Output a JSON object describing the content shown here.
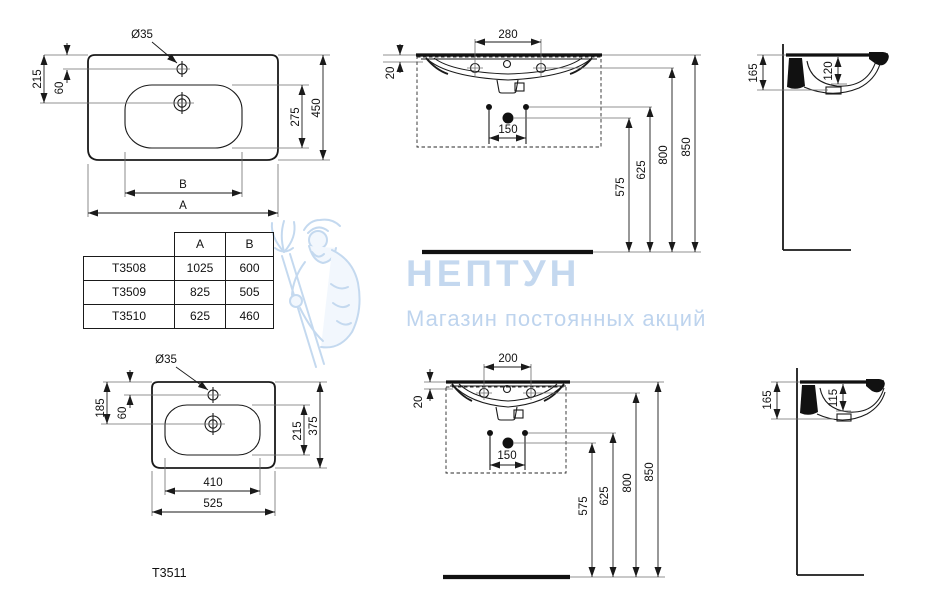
{
  "watermark": {
    "title": "НЕПТУН",
    "subtitle": "Магазин постоянных акций"
  },
  "caption": "T3511",
  "colors": {
    "line": "#1a1a1a",
    "extension_line": "#6e6e6e",
    "watermark_title": "#c4d8ef",
    "watermark_subtitle": "#bed4ee",
    "watermark_figure": "#b9d3ee"
  },
  "table": {
    "headers": [
      "",
      "A",
      "B"
    ],
    "rows": [
      [
        "T3508",
        "1025",
        "600"
      ],
      [
        "T3509",
        "825",
        "505"
      ],
      [
        "T3510",
        "625",
        "460"
      ]
    ]
  },
  "views": {
    "plan_large": {
      "dims": {
        "hole_dia": "Ø35",
        "top_to_drain": "215",
        "top_to_tap": "60",
        "basin_depth": "275",
        "overall_depth": "450",
        "basin_width": "B",
        "overall_width": "A"
      }
    },
    "front_large": {
      "dims": {
        "tap_spacing": "280",
        "rim_thickness": "20",
        "bolt_spacing": "150",
        "drain_height": "575",
        "bolt_height": "625",
        "tap_height": "800",
        "rim_height": "850"
      }
    },
    "side_large": {
      "dims": {
        "apron_height": "165",
        "bowl_depth": "120"
      }
    },
    "plan_small": {
      "dims": {
        "hole_dia": "Ø35",
        "top_to_drain": "185",
        "top_to_tap": "60",
        "basin_depth": "215",
        "overall_depth": "375",
        "basin_width": "410",
        "overall_width": "525"
      }
    },
    "front_small": {
      "dims": {
        "tap_spacing": "200",
        "rim_thickness": "20",
        "bolt_spacing": "150",
        "drain_height": "575",
        "bolt_height": "625",
        "tap_height": "800",
        "rim_height": "850"
      }
    },
    "side_small": {
      "dims": {
        "apron_height": "165",
        "bowl_depth": "115"
      }
    }
  }
}
